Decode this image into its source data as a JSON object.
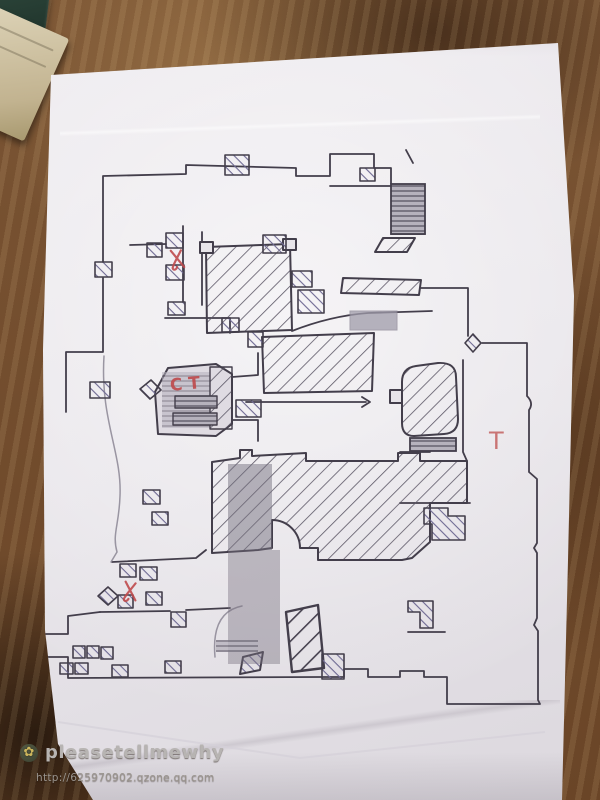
{
  "map": {
    "labels": {
      "ct": "CT",
      "t": "T"
    },
    "marks": [
      {
        "icon": "x-mark-icon"
      },
      {
        "icon": "x-mark-icon"
      }
    ]
  },
  "watermark": {
    "icon": "qzone-flower-icon",
    "name": "pleasetellmewhy",
    "url": "http://625970902.qzone.qq.com"
  },
  "colors": {
    "wood": "#75522f",
    "paper": "#e9e6eb",
    "ink": "#433e4b",
    "pencil_hatch": "#6f6a93",
    "red_annotation": "#bf4a4c",
    "watermark_text": "#b7b4b2"
  }
}
